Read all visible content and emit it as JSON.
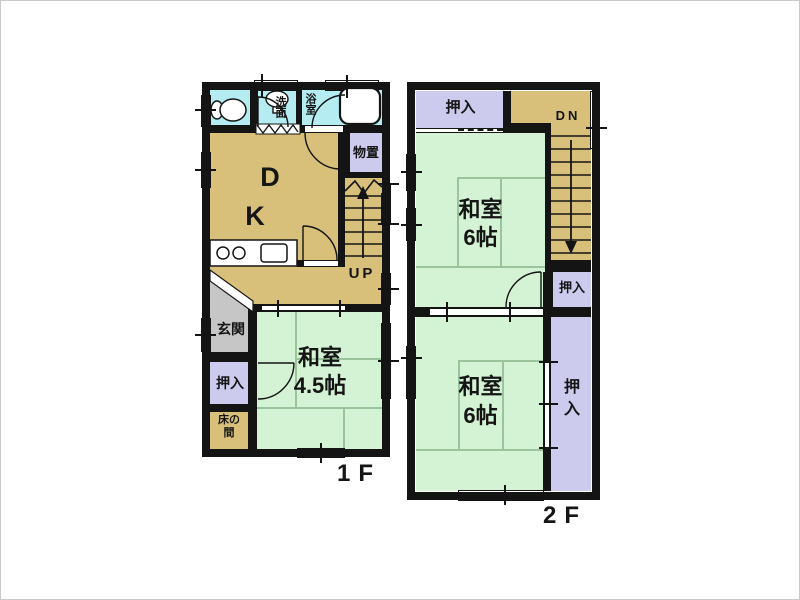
{
  "floorplan": {
    "floor_1": {
      "floor_label": "1F",
      "washroom_label": "洗面",
      "bathroom_label": "浴室",
      "dining_label": "D",
      "kitchen_label": "K",
      "storage_label": "物置",
      "stairs_up_label": "UP",
      "entrance_label": "玄関",
      "closet_label": "押入",
      "tokonoma_line1": "床の",
      "tokonoma_line2": "間",
      "washitsu_name": "和室",
      "washitsu_size": "4.5帖"
    },
    "floor_2": {
      "floor_label": "2F",
      "closet_top_label": "押入",
      "stairs_down_label": "DN",
      "washitsu_upper_name": "和室",
      "washitsu_upper_size": "6帖",
      "closet_mid_label": "押入",
      "washitsu_lower_name": "和室",
      "washitsu_lower_size": "6帖",
      "closet_right_label": "押入"
    },
    "colors": {
      "wall": "#141414",
      "tatami_green": "#d4f2d4",
      "wet_area_cyan": "#b5ecf2",
      "wood_tan": "#d8c07a",
      "closet_purple": "#cccbee",
      "entrance_gray": "#c6c6c6",
      "tatami_line": "#9cc49c"
    }
  }
}
